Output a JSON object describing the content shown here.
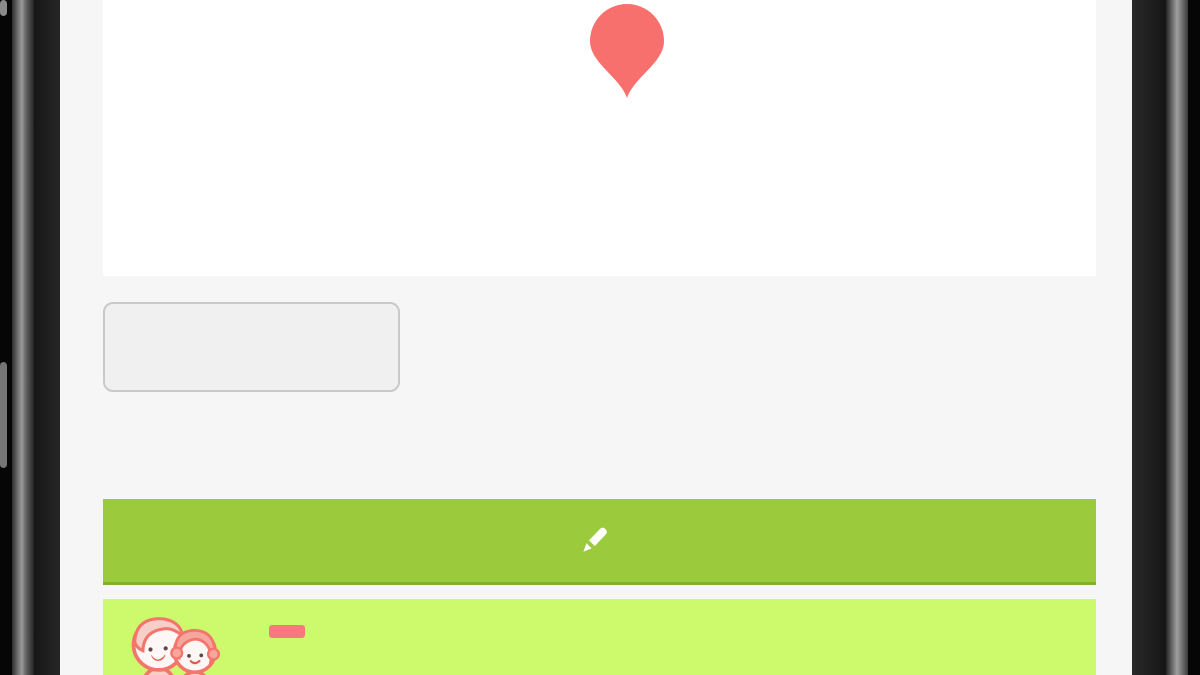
{
  "colors": {
    "comment_button": "#9bcb3c",
    "comment_button_edge": "#83b02c",
    "banner": "#cdfa6d",
    "badge": "#f8797b",
    "pin": "#f7706d",
    "screen_bg": "#f6f6f6",
    "plan_bg": "#ffffff",
    "back_button_bg": "#f0f0f0"
  },
  "pin": {
    "number": "4"
  },
  "back_button": {
    "label": "図面一覧に戻る"
  },
  "comment_button": {
    "label": "コメントを書く",
    "icon": "pencil-icon"
  },
  "topic": {
    "title": "話題4",
    "badge": "要望",
    "avatar": "couple-avatar"
  },
  "plan": {
    "room_labels": [
      {
        "t": "リビング",
        "x": 322,
        "y": 52,
        "s": 15
      },
      {
        "t": "（7帖）",
        "x": 322,
        "y": 70,
        "s": 13
      },
      {
        "t": "物入",
        "x": 616,
        "y": 110,
        "s": 13
      },
      {
        "t": "玄関",
        "x": 722,
        "y": 133,
        "s": 13
      }
    ],
    "notes": [
      {
        "t": "天井点検口",
        "x": 252,
        "y": 103,
        "s": 8
      },
      {
        "t": "(CH=2,400)",
        "x": 300,
        "y": 90,
        "s": 7
      },
      {
        "t": "(CH=2,400)",
        "x": 505,
        "y": 16,
        "s": 7
      },
      {
        "t": "排気口(換気用)",
        "x": 540,
        "y": 58,
        "s": 7
      },
      {
        "t": "天井点検口",
        "x": 566,
        "y": 90,
        "s": 7.5
      },
      {
        "t": "(CH=2,400)",
        "x": 690,
        "y": 10,
        "s": 6.5
      },
      {
        "t": "ミラー(施主支給)",
        "x": 690,
        "y": 36,
        "s": 6.5
      },
      {
        "t": "ベニア下地",
        "x": 688,
        "y": 45,
        "s": 6.5
      },
      {
        "t": "下り壁H=400",
        "x": 706,
        "y": 76,
        "s": 6.5
      },
      {
        "t": "段手スリ",
        "x": 724,
        "y": 86,
        "s": 6.5
      },
      {
        "t": "天井点検口",
        "x": 692,
        "y": 147,
        "s": 7
      },
      {
        "t": "W-024",
        "x": 792,
        "y": 131,
        "s": 6.5
      },
      {
        "t": "H=2330",
        "x": 792,
        "y": 140,
        "s": 6.5
      },
      {
        "t": "カタ",
        "x": 872,
        "y": 9,
        "s": 6.5
      },
      {
        "t": "※網戸",
        "x": 868,
        "y": 18,
        "s": 6.5
      },
      {
        "t": "※網戸",
        "x": 340,
        "y": 219,
        "s": 7
      },
      {
        "t": "※網戸",
        "x": 512,
        "y": 219,
        "s": 7
      },
      {
        "t": "227.5",
        "x": 206,
        "y": 197,
        "s": 6.5
      },
      {
        "t": "227.5",
        "x": 236,
        "y": 197,
        "s": 6.5
      },
      {
        "t": "227.5",
        "x": 436,
        "y": 199,
        "s": 6.5
      },
      {
        "t": "227.5",
        "x": 466,
        "y": 199,
        "s": 6.5
      },
      {
        "t": "227.5",
        "x": 450,
        "y": 209,
        "s": 6.5
      }
    ],
    "spec_boxes": [
      {
        "x": 167,
        "y": 26,
        "w": 42,
        "rows": [
          "Fix窓",
          "16503",
          "FL+2300",
          "カタ"
        ]
      },
      {
        "x": 333,
        "y": 166,
        "w": 42,
        "rows": [
          "引違い窓",
          "16022",
          "FL+2000",
          "トーメイ"
        ]
      },
      {
        "x": 505,
        "y": 166,
        "w": 42,
        "rows": [
          "引違い窓",
          "16022",
          "FL+2000",
          "トーメイ"
        ]
      },
      {
        "x": 686,
        "y": 185,
        "w": 42,
        "rows": [
          "Fix窓",
          "03613",
          "FL+2000",
          "トーメイ"
        ]
      },
      {
        "x": 868,
        "y": 26,
        "w": 40,
        "rows": [
          "Fix窓",
          "04613",
          "FL+2000",
          "カタ"
        ]
      },
      {
        "x": 859,
        "y": 101,
        "w": 40,
        "rows": [
          "片開戸",
          "FL+2065",
          "W型"
        ]
      }
    ],
    "dim_rows": [
      {
        "line_y": 232,
        "x1": 222,
        "x2": 787,
        "ticks": [
          222,
          273,
          325,
          376,
          427,
          479,
          530,
          581,
          633,
          684,
          735,
          787
        ],
        "labels": [
          {
            "t": "910",
            "x": 248
          },
          {
            "t": "910",
            "x": 299
          },
          {
            "t": "910",
            "x": 350
          },
          {
            "t": "910",
            "x": 402
          },
          {
            "t": "910",
            "x": 453
          },
          {
            "t": "910",
            "x": 505
          },
          {
            "t": "910",
            "x": 556
          },
          {
            "t": "910",
            "x": 607
          },
          {
            "t": "910",
            "x": 710
          },
          {
            "t": "910",
            "x": 761
          }
        ]
      },
      {
        "line_y": 250,
        "x1": 222,
        "x2": 787,
        "ticks": [
          222,
          428,
          633,
          659,
          684,
          787
        ],
        "labels": [
          {
            "t": "3,640",
            "x": 325
          },
          {
            "t": "3,640",
            "x": 530
          },
          {
            "t": "455",
            "x": 646
          },
          {
            "t": "455",
            "x": 671
          },
          {
            "t": "1,820",
            "x": 736
          }
        ]
      },
      {
        "line_y": 267,
        "x1": 222,
        "x2": 855,
        "ticks": [
          222,
          787,
          855
        ],
        "labels": [
          {
            "t": "10,010",
            "x": 504
          },
          {
            "t": "1,213",
            "x": 821
          }
        ]
      }
    ],
    "left_dims": [
      {
        "t": "910",
        "x": 131,
        "y": 44
      },
      {
        "t": "910",
        "x": 131,
        "y": 89
      },
      {
        "t": "455",
        "x": 131,
        "y": 126
      },
      {
        "t": "3,185",
        "x": 114,
        "y": 62
      },
      {
        "t": "455",
        "x": 114,
        "y": 152
      }
    ],
    "right_dims": [
      {
        "t": "910",
        "x": 916,
        "y": 42
      },
      {
        "t": "455",
        "x": 912,
        "y": 84
      },
      {
        "t": "1,520",
        "x": 930,
        "y": 114
      },
      {
        "t": "1,062",
        "x": 912,
        "y": 125
      },
      {
        "t": "303",
        "x": 912,
        "y": 160
      }
    ]
  }
}
